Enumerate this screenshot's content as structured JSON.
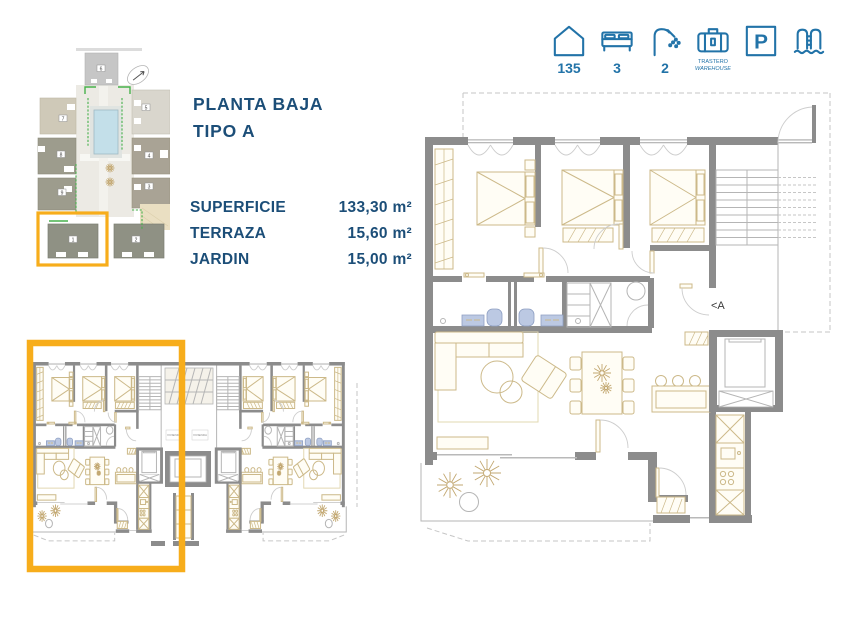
{
  "colors": {
    "accent_blue": "#2273a8",
    "navy_text": "#1c4e78",
    "highlight_orange": "#f7ad1b",
    "wall_gray": "#8c8c8c",
    "furniture_tan": "#ccb989",
    "fixture_blue": "#bcc9e3",
    "pool_blue": "#c3dfe9",
    "landscape_green": "#46b14b"
  },
  "header": {
    "features": [
      {
        "name": "surface",
        "value": "135"
      },
      {
        "name": "bedrooms",
        "value": "3"
      },
      {
        "name": "bathrooms",
        "value": "2"
      },
      {
        "name": "storage",
        "label": "TRASTERO",
        "sublabel": "WAREHOUSE"
      },
      {
        "name": "parking",
        "letter": "P"
      },
      {
        "name": "pool"
      }
    ]
  },
  "plan_info": {
    "title": "PLANTA BAJA",
    "subtitle": "TIPO A",
    "specs": [
      {
        "label": "SUPERFICIE",
        "value": "133,30 m²"
      },
      {
        "label": "TERRAZA",
        "value": "15,60 m²"
      },
      {
        "label": "JARDIN",
        "value": "15,00 m²"
      }
    ]
  },
  "site_plan": {
    "buildings": [
      "6",
      "5",
      "4",
      "3",
      "7",
      "8",
      "9",
      "1",
      "2"
    ]
  },
  "main_plan": {
    "section_label": "<A"
  },
  "duplex_plan": {
    "unit_label": "VIVIENDA",
    "highlighted_unit": "left"
  }
}
